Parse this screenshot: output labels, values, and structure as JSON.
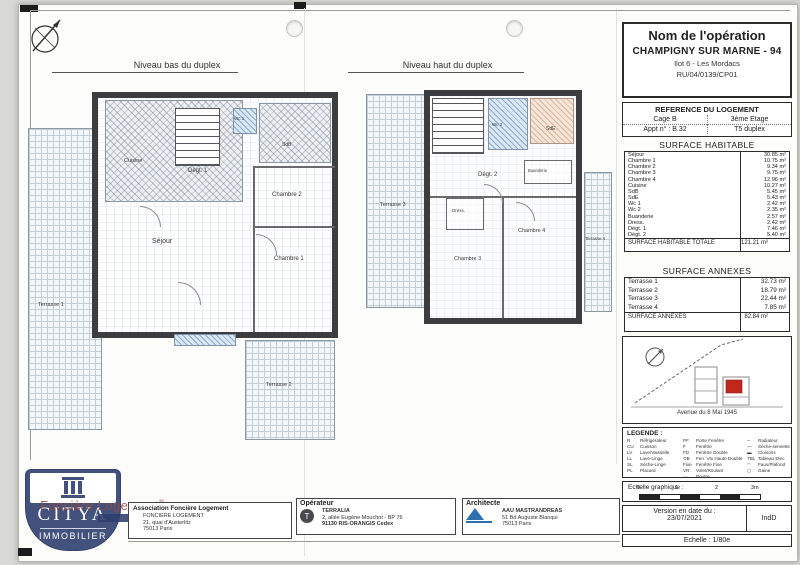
{
  "colors": {
    "wall": "#3d3d40",
    "accent_red": "#c1271b",
    "citya_blue": "#43527c",
    "architect_blue": "#2f6fae"
  },
  "plans": {
    "lower": {
      "title": "Niveau bas du duplex",
      "rooms": {
        "cuisine": "Cuisine",
        "wc1": "Wc 1",
        "sdb": "SdB",
        "degt1": "Dégt. 1",
        "chambre2": "Chambre 2",
        "sejour": "Séjour",
        "chambre1": "Chambre 1",
        "terrasse1": "Terrasse 1",
        "terrasse2": "Terrasse 2"
      }
    },
    "upper": {
      "title": "Niveau haut du duplex",
      "rooms": {
        "terrasse3": "Terrasse 3",
        "wc2": "Wc 2",
        "sde": "SdE",
        "degt2": "Dégt. 2",
        "buanderie": "Buanderie",
        "dress": "Dress.",
        "chambre4": "Chambre 4",
        "chambre3": "Chambre 3",
        "terrasse4": "Terrasse 4"
      }
    }
  },
  "operation": {
    "title": "Nom de l'opération",
    "name": "CHAMPIGNY SUR MARNE - 94",
    "line2": "Ilot 6 - Les Mordacs",
    "ref_code": "RU/04/0139/CP01"
  },
  "reference": {
    "title": "REFERENCE DU LOGEMENT",
    "cage": "Cage B",
    "etage": "3ème Etage",
    "appt": "Appt n° : B.32",
    "type": "T5 duplex"
  },
  "surface_habitable": {
    "title": "SURFACE HABITABLE",
    "rows": [
      {
        "label": "Séjour",
        "value": "30.85 m²"
      },
      {
        "label": "Chambre 1",
        "value": "10.75 m²"
      },
      {
        "label": "Chambre 2",
        "value": "9.34 m²"
      },
      {
        "label": "Chambre 3",
        "value": "9.75 m²"
      },
      {
        "label": "Chambre 4",
        "value": "12.96 m²"
      },
      {
        "label": "Cuisine",
        "value": "10.27 m²"
      },
      {
        "label": "SdB",
        "value": "5.45 m²"
      },
      {
        "label": "SdE",
        "value": "5.43 m²"
      },
      {
        "label": "Wc 1",
        "value": "2.42 m²"
      },
      {
        "label": "Wc 2",
        "value": "2.35 m²"
      },
      {
        "label": "Buanderie",
        "value": "2.57 m²"
      },
      {
        "label": "Dress.",
        "value": "2.42 m²"
      },
      {
        "label": "Dégt. 1",
        "value": "7.46 m²"
      },
      {
        "label": "Dégt. 2",
        "value": "5.40 m²"
      }
    ],
    "total_label": "SURFACE HABITABLE TOTALE",
    "total_value": "121.21 m²"
  },
  "surface_annexes": {
    "title": "SURFACE ANNEXES",
    "rows": [
      {
        "label": "Terrasse 1",
        "value": "32.73 m²"
      },
      {
        "label": "Terrasse 2",
        "value": "18.79 m²"
      },
      {
        "label": "Terrasse 3",
        "value": "22.44 m²"
      },
      {
        "label": "Terrasse 4",
        "value": "7.85 m²"
      }
    ],
    "total_label": "SURFACE ANNEXES",
    "total_value": "82.84 m²"
  },
  "situation": {
    "street": "Avenue du 8 Mai 1945"
  },
  "legend": {
    "title": "LEGENDE :",
    "col1": [
      {
        "abbr": "R",
        "label": "Réfrigérateur"
      },
      {
        "abbr": "CU",
        "label": "Cuisson"
      },
      {
        "abbr": "LV",
        "label": "Lave/Vaisselle"
      },
      {
        "abbr": "LL",
        "label": "Lave-Linge"
      },
      {
        "abbr": "SL",
        "label": "Sèche-Linge"
      },
      {
        "abbr": "PL",
        "label": "Placard"
      }
    ],
    "col2": [
      {
        "abbr": "PF",
        "label": "Porte Fenêtre"
      },
      {
        "abbr": "F",
        "label": "Fenêtre"
      },
      {
        "abbr": "FD",
        "label": "Fenêtre Double"
      },
      {
        "abbr": "OB",
        "label": "Fen. Vtx Haute Double"
      },
      {
        "abbr": "Fixe",
        "label": "Fenêtre Fixe"
      },
      {
        "abbr": "VR",
        "label": "Volet/Roulant"
      },
      {
        "abbr": "⋯",
        "label": "Poutre"
      }
    ],
    "col3": [
      {
        "abbr": "~",
        "label": "Radiateur"
      },
      {
        "abbr": "—",
        "label": "Sèche-serviette"
      },
      {
        "abbr": "▬",
        "label": "Cloisons"
      },
      {
        "abbr": "TBL",
        "label": "Tableau Elec."
      },
      {
        "abbr": "◠",
        "label": "Faux/Plafond"
      },
      {
        "abbr": "▢",
        "label": "Gaine"
      }
    ]
  },
  "scale": {
    "title": "Echelle graphique :",
    "ticks": [
      "0",
      "1",
      "2",
      "3m"
    ]
  },
  "version": {
    "label": "Version en date du :",
    "date": "23/07/2021",
    "index": "IndD",
    "echelle": "Echelle : 1/80e"
  },
  "bottom": {
    "citya": {
      "name": "CITYA",
      "sub": "IMMOBILIER"
    },
    "stamp": "Foncière Logement",
    "association": {
      "title": "Association Foncière Logement",
      "line1": "FONCIERE LOGEMENT",
      "line2": "21, quai d'Austerlitz",
      "line3": "75013 Paris"
    },
    "operateur": {
      "title": "Opérateur",
      "name": "TERRALIA",
      "line2": "2, allée Eugène Mouchot - BP 76",
      "line3": "91130 RIS-ORANGIS Cedex"
    },
    "architecte": {
      "title": "Architecte",
      "name": "AAU MASTRANDREAS",
      "line2": "51 Bd Auguste Blanqui",
      "line3": "75013 Paris"
    }
  }
}
